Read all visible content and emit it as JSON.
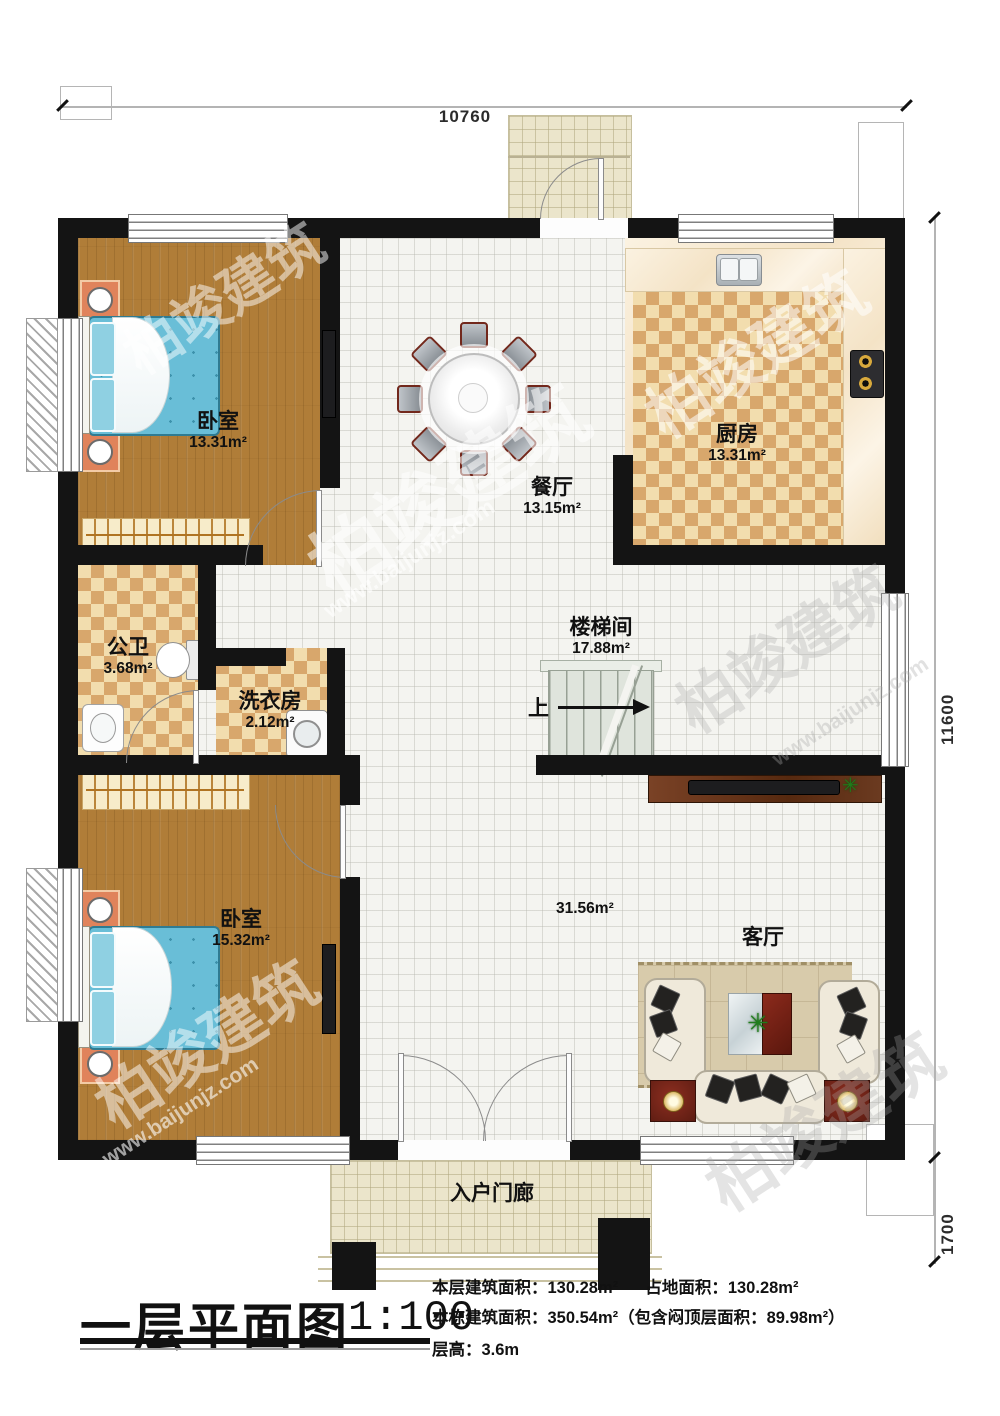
{
  "watermark": {
    "logo": "柏竣建筑",
    "url": "www.baijunjz.com"
  },
  "dimensions": {
    "top": "10760",
    "right": "11600",
    "bottom_right": "1700"
  },
  "rooms": {
    "bedroom1": {
      "name": "卧室",
      "area": "13.31m²"
    },
    "dining": {
      "name": "餐厅",
      "area": "13.15m²"
    },
    "kitchen": {
      "name": "厨房",
      "area": "13.31m²"
    },
    "bathroom": {
      "name": "公卫",
      "area": "3.68m²"
    },
    "laundry": {
      "name": "洗衣房",
      "area": "2.12m²"
    },
    "stairwell": {
      "name": "楼梯间",
      "area": "17.88m²",
      "up": "上"
    },
    "bedroom2": {
      "name": "卧室",
      "area": "15.32m²"
    },
    "living": {
      "name": "客厅",
      "area": "31.56m²"
    },
    "porch": {
      "name": "入户门廊"
    }
  },
  "icons": {
    "plant_glyph": "✳"
  },
  "title_block": {
    "title": "一层平面图",
    "scale": "1:100",
    "floor_area_label": "本层建筑面积：130.28m²",
    "land_area_label": "占地面积：130.28m²",
    "total_area_label": "本栋建筑面积：350.54m²（包含闷顶层面积：89.98m²）",
    "height_label": "层高：3.6m"
  }
}
